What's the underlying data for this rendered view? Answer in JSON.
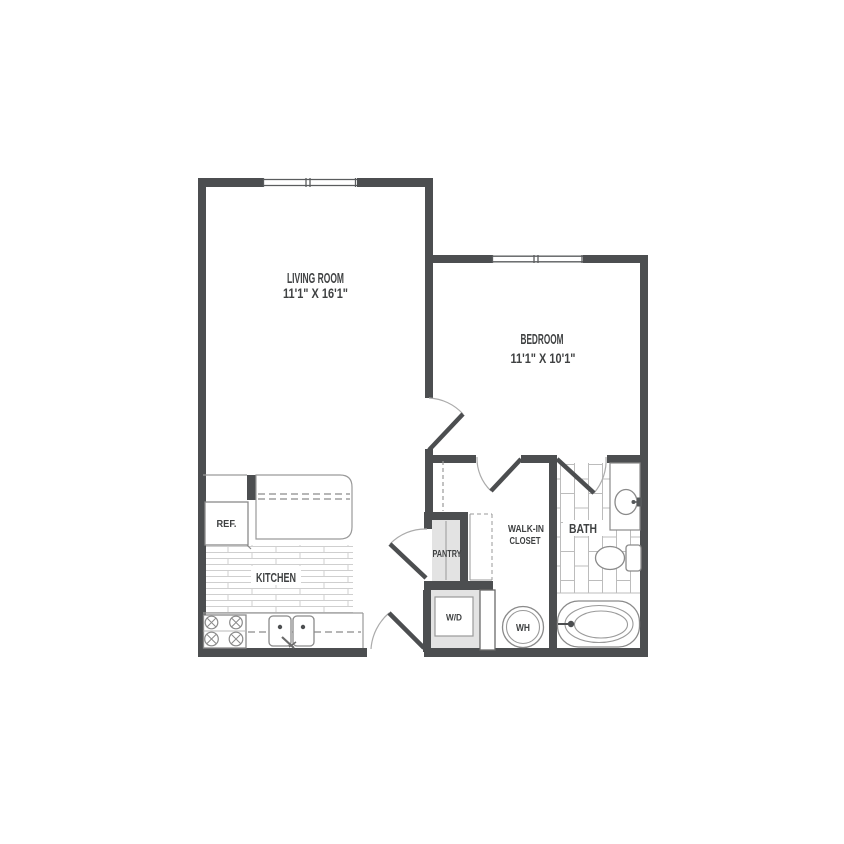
{
  "floor_plan": {
    "rooms": {
      "living_room": {
        "name": "LIVING ROOM",
        "dimensions": "11'1\" X 16'1\""
      },
      "bedroom": {
        "name": "BEDROOM",
        "dimensions": "11'1\" X 10'1\""
      },
      "kitchen": {
        "name": "KITCHEN"
      },
      "pantry": {
        "name": "PANTRY"
      },
      "walk_in_closet": {
        "line1": "WALK-IN",
        "line2": "CLOSET"
      },
      "bath": {
        "name": "BATH"
      }
    },
    "appliances": {
      "refrigerator": "REF.",
      "washer_dryer": "W/D",
      "water_heater": "WH"
    },
    "colors": {
      "wall": "#4c4e50",
      "closet_fill": "#e3e3e3",
      "fixture_outline": "#8a8a8a",
      "tile_line": "#bcbcbc",
      "plank_line": "#cfcfcf",
      "text": "#3f4142",
      "background": "#ffffff"
    }
  }
}
